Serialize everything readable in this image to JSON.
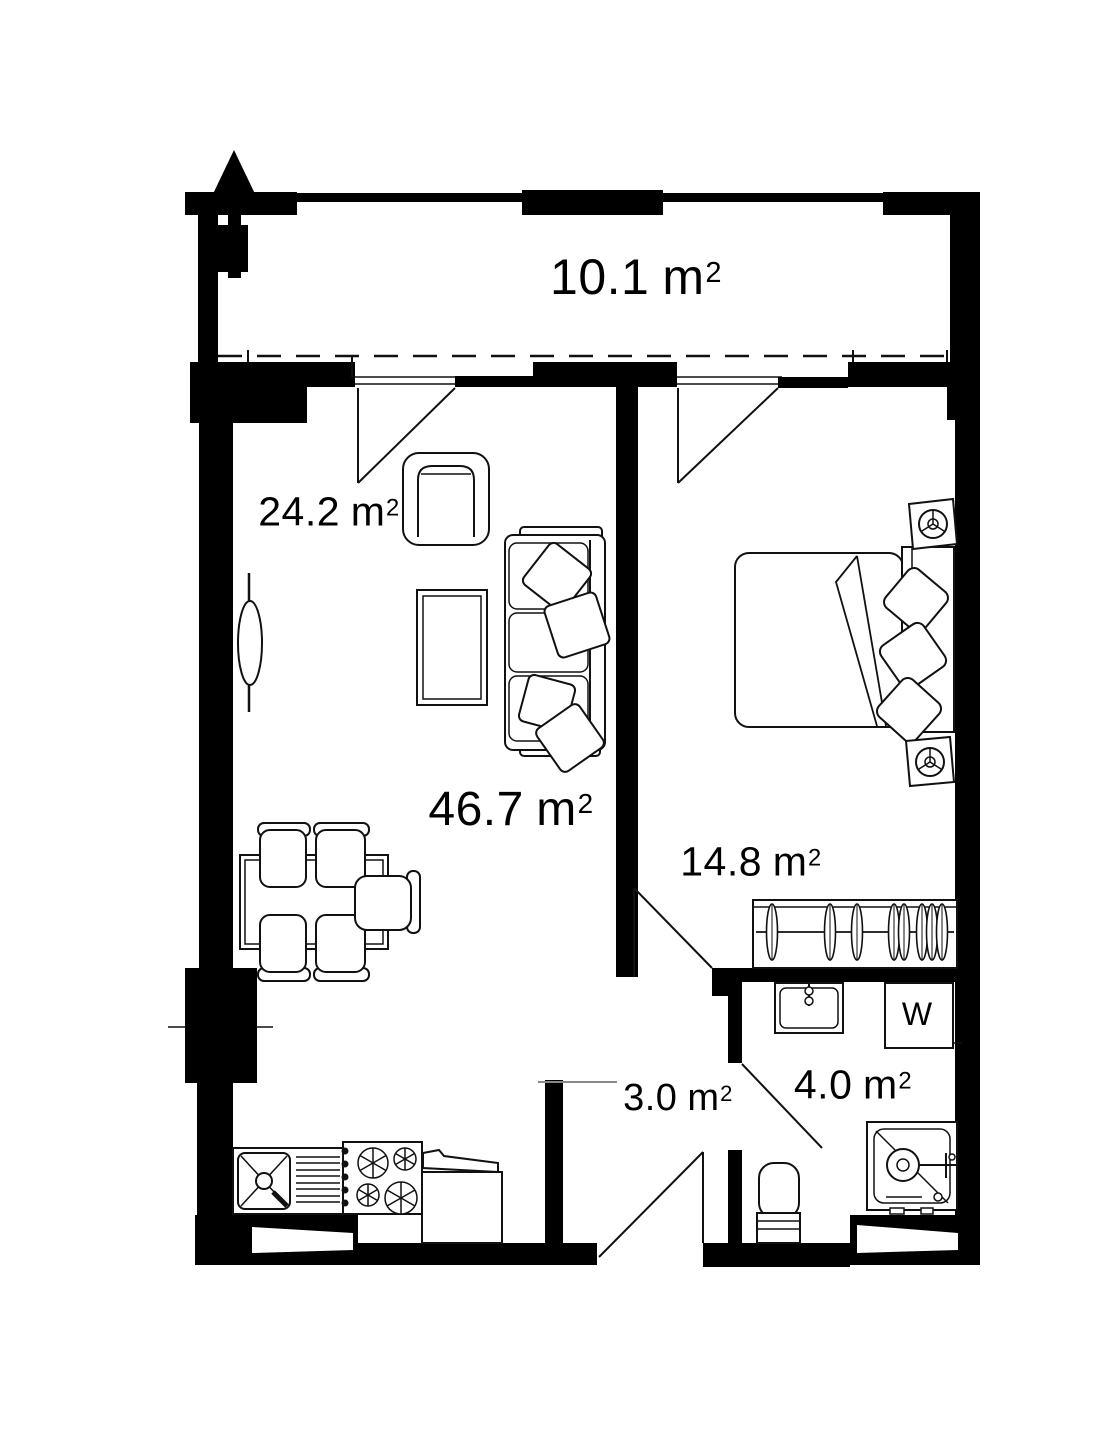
{
  "colors": {
    "wall": "#000000",
    "ink": "#111111",
    "background": "#ffffff",
    "muted_line": "#888888"
  },
  "units": {
    "symbol": "m",
    "exponent": "2"
  },
  "rooms": [
    {
      "id": "balcony",
      "area": "10.1"
    },
    {
      "id": "living-room",
      "area": "46.7"
    },
    {
      "id": "living-room-zone",
      "area": "24.2"
    },
    {
      "id": "bedroom",
      "area": "14.8"
    },
    {
      "id": "hallway",
      "area": "3.0"
    },
    {
      "id": "bathroom",
      "area": "4.0"
    }
  ],
  "appliances": {
    "washing_machine_label": "W"
  }
}
